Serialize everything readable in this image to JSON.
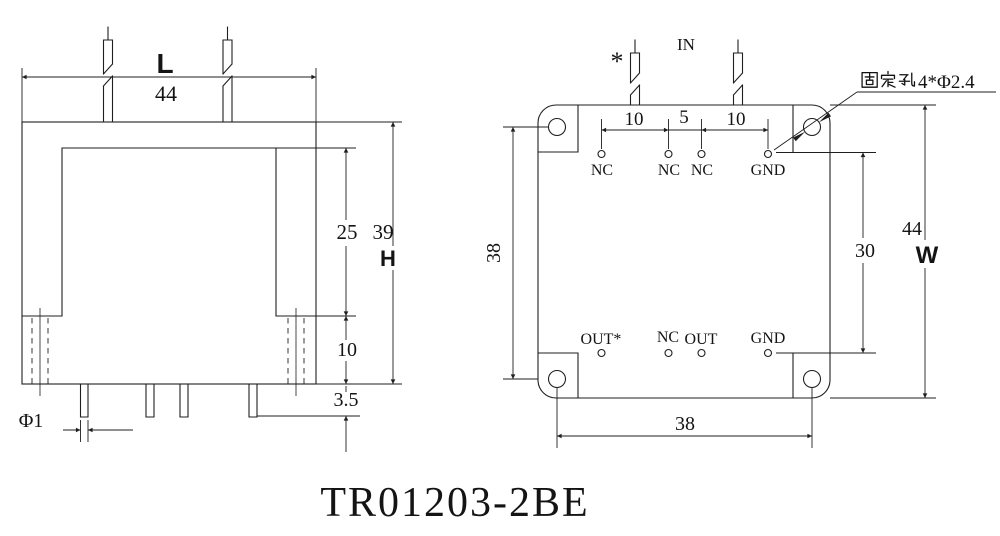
{
  "drawing_title": "TR01203-2BE",
  "side_view": {
    "width_letter": "L",
    "width_value": "44",
    "window_height": "25",
    "body_height": "39",
    "height_letter": "H",
    "flange_height": "10",
    "pin_standoff": "3.5",
    "pin_diameter": "Φ1"
  },
  "top_view": {
    "input_label": "IN",
    "polarity_mark": "*",
    "fixing_hole_label": "固定孔4*Φ2.4",
    "fixing_hole_suffix": "4*Φ2.4",
    "pitch_left": "10",
    "pitch_mid": "5",
    "pitch_right": "10",
    "hole_span_vertical": "38",
    "pad_row_span": "30",
    "body_width": "44",
    "width_letter": "W",
    "hole_span_horizontal": "38",
    "top_row_pads": [
      "NC",
      "NC",
      "NC",
      "GND"
    ],
    "bottom_row_pads": [
      "OUT*",
      "NC",
      "OUT",
      "GND"
    ]
  }
}
